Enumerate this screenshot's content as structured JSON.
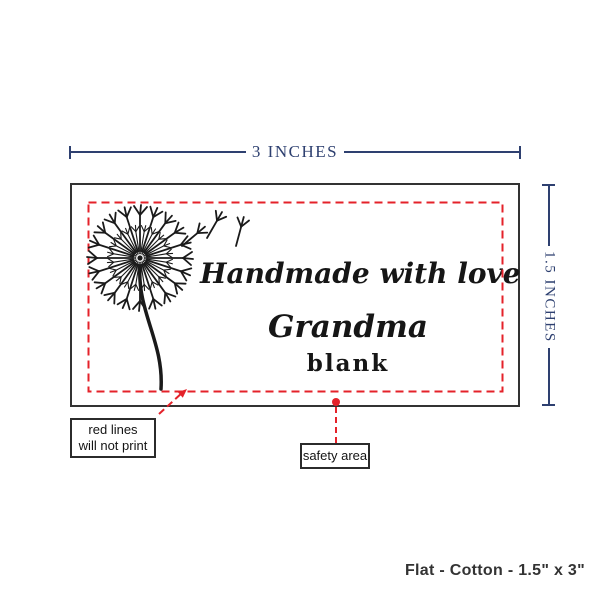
{
  "measurements": {
    "width_label": "3 INCHES",
    "height_label": "1.5 INCHES"
  },
  "label_design": {
    "line1": "Handmade with love by",
    "line2": "Grandma",
    "line3": "blank"
  },
  "callouts": {
    "red_lines": {
      "line1": "red lines",
      "line2": "will not print"
    },
    "safety_area": {
      "label": "safety area"
    }
  },
  "footer": {
    "product_info": "Flat - Cotton - 1.5\" x 3\""
  },
  "colors": {
    "dimension_line": "#2e4070",
    "no_print_red": "#e4222a",
    "label_border": "#333333",
    "ink": "#1a1a1a"
  },
  "icons": {
    "dandelion": "dandelion-with-flying-seeds-illustration"
  }
}
